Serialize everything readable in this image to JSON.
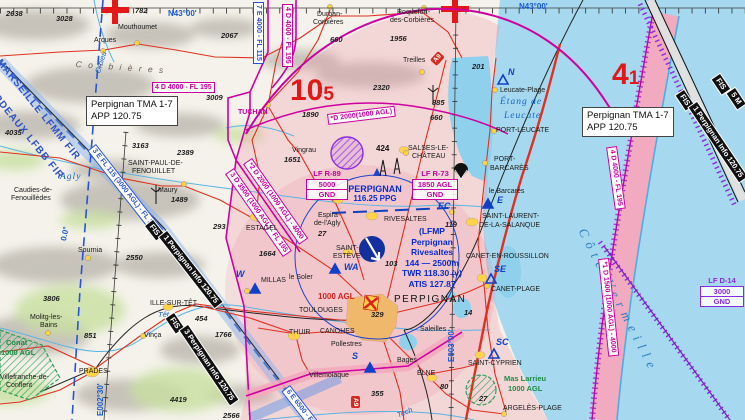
{
  "tma_note": {
    "line1": "Perpignan TMA 1-7",
    "line2": "APP 120.75"
  },
  "areas": {
    "r89": {
      "id": "LF R-89",
      "upper": "5000",
      "lower": "GND"
    },
    "r73": {
      "id": "LF R-73",
      "upper": "1850 AGL",
      "lower": "GND"
    },
    "d14": {
      "id": "LF D-14",
      "upper": "3000",
      "lower": "GND"
    }
  },
  "airport": {
    "icao": "(LFMP",
    "name1": "Perpignan",
    "name2": "Rivesaltes",
    "dims": "144 — 2500m",
    "twr": "TWR 118.30 (v)",
    "atis": "ATIS 127.87"
  },
  "vor": {
    "name": "PERPIGNAN",
    "freq": "116.25 PPG"
  },
  "max_elev": {
    "west": {
      "big": "10",
      "sub": "5"
    },
    "east": {
      "big": "4",
      "sub": "1"
    }
  },
  "badges": {
    "motorway": "A9"
  },
  "colors": {
    "airspace_d": "#c8009e",
    "airspace_e": "#2a52d0",
    "sea": "#a6d9ef",
    "tma_tint": "#f3b8c6",
    "road": "#e03020",
    "fis_band": "#101010",
    "water_text": "#1464c8",
    "red_figure": "#e01818"
  },
  "map": {
    "labels": [
      {
        "name": "lat-label-west",
        "text": "N43°00'",
        "x": 168,
        "y": 10,
        "cls": "blue-geo"
      },
      {
        "name": "lat-label-east",
        "text": "N43°00'",
        "x": 519,
        "y": 3,
        "cls": "blue-geo"
      },
      {
        "name": "lon-label-west",
        "text": "E002°30'",
        "x": 97,
        "y": 416,
        "cls": "blue-geo",
        "rot": -90
      },
      {
        "name": "lon-label-east",
        "text": "E003°00'",
        "x": 448,
        "y": 362,
        "cls": "blue-geo",
        "rot": -90
      },
      {
        "name": "agonic-label",
        "text": "0.0°",
        "x": 60,
        "y": 240,
        "cls": "blue-geo",
        "rot": -78
      },
      {
        "name": "fir-label-marseille",
        "text": "MARSEILLE LFMM FIR",
        "x": 2,
        "y": 58,
        "cls": "fir",
        "rot": 51
      },
      {
        "name": "fir-label-bordeaux",
        "text": "BORDEAUX LFBB FIR",
        "x": -12,
        "y": 80,
        "cls": "fir",
        "rot": 51
      },
      {
        "name": "river-orbieu",
        "text": "Orbieu",
        "x": 94,
        "y": 72,
        "cls": "water",
        "rot": -72
      },
      {
        "name": "range-corbieres",
        "text": "C o r b i è r e s",
        "x": 76,
        "y": 60,
        "cls": "range",
        "rot": 4
      },
      {
        "name": "river-agly",
        "text": "Agly",
        "x": 60,
        "y": 173,
        "cls": "water-lg"
      },
      {
        "name": "river-tet",
        "text": "Têt",
        "x": 158,
        "y": 311,
        "cls": "water"
      },
      {
        "name": "river-tech",
        "text": "Tech",
        "x": 396,
        "y": 412,
        "cls": "water",
        "rot": -22
      },
      {
        "name": "etang-leucate-1",
        "text": "Étang de",
        "x": 500,
        "y": 98,
        "cls": "water-lg"
      },
      {
        "name": "etang-leucate-2",
        "text": "Leucate",
        "x": 504,
        "y": 112,
        "cls": "water-lg"
      },
      {
        "name": "cote-vermeille",
        "text": "Côte Vermeille",
        "x": 588,
        "y": 226,
        "cls": "water-xl",
        "rot": 63
      },
      {
        "name": "asp-4d-west",
        "text": "4 D 4000 - FL 195",
        "x": 152,
        "y": 82,
        "cls": "asp asp-d"
      },
      {
        "name": "asp-7e-top",
        "text": "7 E 4000 - FL 115",
        "x": 264,
        "y": 2,
        "cls": "asp asp-e",
        "rot": 90
      },
      {
        "name": "asp-4d-top",
        "text": "4 D 4000 - FL 195",
        "x": 293,
        "y": 4,
        "cls": "asp asp-d",
        "rot": 90
      },
      {
        "name": "asp-4d-coast",
        "text": "4 D 4000 - FL 195",
        "x": 617,
        "y": 146,
        "cls": "asp asp-d",
        "rot": 82
      },
      {
        "name": "asp-1d-coast",
        "text": "*1 D 1500 (1000 AGL) - 4000",
        "x": 609,
        "y": 258,
        "cls": "asp asp-d",
        "rot": 84
      },
      {
        "name": "asp-d2000-arc",
        "text": "*D 2000(1000 AGL)",
        "x": 327,
        "y": 114,
        "cls": "asp asp-d",
        "rot": -7
      },
      {
        "name": "asp-2d",
        "text": "*2 D 2000 (1000 AGL) - 4000",
        "x": 252,
        "y": 158,
        "cls": "asp asp-d",
        "rot": 55
      },
      {
        "name": "asp-3d",
        "text": "3 D 3500 (1000 AGL) - FL 195",
        "x": 234,
        "y": 168,
        "cls": "asp asp-d",
        "rot": 55
      },
      {
        "name": "asp-3e",
        "text": "3 E FL 115 (3000 AGL) - FL 195",
        "x": 96,
        "y": 144,
        "cls": "asp asp-e",
        "rot": 52
      },
      {
        "name": "asp-6e",
        "text": "6 E 6500 - FL 115",
        "x": 290,
        "y": 385,
        "cls": "asp asp-e",
        "rot": 52
      },
      {
        "name": "fis-1-tag",
        "text": "FIS",
        "x": 153,
        "y": 220,
        "cls": "fis",
        "rot": 52
      },
      {
        "name": "fis-1-label",
        "text": "1 Perpignan Info 120.75",
        "x": 167,
        "y": 231,
        "cls": "fis",
        "rot": 52
      },
      {
        "name": "fis-3-tag",
        "text": "FIS",
        "x": 174,
        "y": 313,
        "cls": "fis",
        "rot": 56
      },
      {
        "name": "fis-3-label",
        "text": "3 Perpignan Info 120.75",
        "x": 188,
        "y": 325,
        "cls": "fis",
        "rot": 56
      },
      {
        "name": "fis-east-tag",
        "text": "FIS",
        "x": 684,
        "y": 90,
        "cls": "fis",
        "rot": 56
      },
      {
        "name": "fis-east-label",
        "text": "1 Perpignan Info 120.75",
        "x": 697,
        "y": 102,
        "cls": "fis",
        "rot": 56
      },
      {
        "name": "fis-east2-tag",
        "text": "FIS",
        "x": 720,
        "y": 74,
        "cls": "fis",
        "rot": 56
      },
      {
        "name": "fis-east2-label",
        "text": "5 M",
        "x": 735,
        "y": 88,
        "cls": "fis",
        "rot": 56
      },
      {
        "name": "vfr-point-n",
        "text": "N",
        "x": 508,
        "y": 68,
        "cls": "vfr"
      },
      {
        "name": "vfr-point-w",
        "text": "W",
        "x": 236,
        "y": 270,
        "cls": "vfr"
      },
      {
        "name": "vfr-point-wa",
        "text": "WA",
        "x": 344,
        "y": 263,
        "cls": "vfr"
      },
      {
        "name": "vfr-point-s",
        "text": "S",
        "x": 352,
        "y": 352,
        "cls": "vfr"
      },
      {
        "name": "vfr-point-e",
        "text": "E",
        "x": 497,
        "y": 196,
        "cls": "vfr"
      },
      {
        "name": "vfr-point-se",
        "text": "SE",
        "x": 494,
        "y": 265,
        "cls": "vfr"
      },
      {
        "name": "vfr-point-sc",
        "text": "SC",
        "x": 496,
        "y": 338,
        "cls": "vfr"
      },
      {
        "name": "vfr-point-ec",
        "text": "EC",
        "x": 438,
        "y": 202,
        "cls": "vfr"
      },
      {
        "name": "town-mouthoumet",
        "text": "Mouthoumet",
        "x": 118,
        "y": 24,
        "cls": "town"
      },
      {
        "name": "town-arques",
        "text": "Arques",
        "x": 94,
        "y": 37,
        "cls": "town"
      },
      {
        "name": "town-durban-1",
        "text": "Durban-",
        "x": 317,
        "y": 11,
        "cls": "town"
      },
      {
        "name": "town-durban-2",
        "text": "Corbières",
        "x": 313,
        "y": 19,
        "cls": "town"
      },
      {
        "name": "town-roquefort-1",
        "text": "Roquefort-",
        "x": 397,
        "y": 9,
        "cls": "town"
      },
      {
        "name": "town-roquefort-2",
        "text": "des-Corbières",
        "x": 390,
        "y": 17,
        "cls": "town"
      },
      {
        "name": "town-treilles",
        "text": "Treilles",
        "x": 403,
        "y": 57,
        "cls": "town"
      },
      {
        "name": "town-leucate-plage",
        "text": "Leucate-Plage",
        "x": 500,
        "y": 87,
        "cls": "town"
      },
      {
        "name": "town-port-leucate",
        "text": "PORT-LEUCATE",
        "x": 496,
        "y": 127,
        "cls": "town"
      },
      {
        "name": "town-tuchan",
        "text": "TUCHAN",
        "x": 238,
        "y": 109,
        "cls": "town magenta-town"
      },
      {
        "name": "town-st-paul-1",
        "text": "SAINT-PAUL-DE-",
        "x": 128,
        "y": 160,
        "cls": "town"
      },
      {
        "name": "town-st-paul-2",
        "text": "FENOUILLET",
        "x": 132,
        "y": 168,
        "cls": "town"
      },
      {
        "name": "town-caudies-1",
        "text": "Caudies-de-",
        "x": 14,
        "y": 187,
        "cls": "town"
      },
      {
        "name": "town-caudies-2",
        "text": "Fenouillèdes",
        "x": 11,
        "y": 195,
        "cls": "town"
      },
      {
        "name": "town-maury",
        "text": "Maury",
        "x": 158,
        "y": 187,
        "cls": "town"
      },
      {
        "name": "town-sournia",
        "text": "Sournia",
        "x": 78,
        "y": 247,
        "cls": "town"
      },
      {
        "name": "town-estagel",
        "text": "ESTAGEL",
        "x": 246,
        "y": 225,
        "cls": "town"
      },
      {
        "name": "town-vingrau",
        "text": "Vingrau",
        "x": 292,
        "y": 147,
        "cls": "town"
      },
      {
        "name": "town-salses-1",
        "text": "SALSES-LE-",
        "x": 408,
        "y": 145,
        "cls": "town"
      },
      {
        "name": "town-salses-2",
        "text": "CHÂTEAU",
        "x": 412,
        "y": 153,
        "cls": "town"
      },
      {
        "name": "town-espira-1",
        "text": "Espira-",
        "x": 318,
        "y": 212,
        "cls": "town"
      },
      {
        "name": "town-espira-2",
        "text": "de-l'Agly",
        "x": 314,
        "y": 220,
        "cls": "town"
      },
      {
        "name": "town-rivesaltes",
        "text": "RIVESALTES",
        "x": 384,
        "y": 216,
        "cls": "town"
      },
      {
        "name": "town-st-esteve-1",
        "text": "SAINT-",
        "x": 336,
        "y": 245,
        "cls": "town"
      },
      {
        "name": "town-st-esteve-2",
        "text": "ESTÈVE",
        "x": 333,
        "y": 253,
        "cls": "town"
      },
      {
        "name": "town-millas",
        "text": "MILLAS",
        "x": 261,
        "y": 277,
        "cls": "town"
      },
      {
        "name": "town-le-soler",
        "text": "le Soler",
        "x": 289,
        "y": 274,
        "cls": "town"
      },
      {
        "name": "town-ille-sur-tet",
        "text": "ILLE-SUR-TÊT",
        "x": 150,
        "y": 300,
        "cls": "town"
      },
      {
        "name": "town-vinca",
        "text": "Vinça",
        "x": 144,
        "y": 332,
        "cls": "town"
      },
      {
        "name": "town-molitg-1",
        "text": "Molitg-les-",
        "x": 30,
        "y": 314,
        "cls": "town"
      },
      {
        "name": "town-molitg-2",
        "text": "Bains",
        "x": 40,
        "y": 322,
        "cls": "town"
      },
      {
        "name": "town-prades",
        "text": "PRADES",
        "x": 79,
        "y": 368,
        "cls": "town"
      },
      {
        "name": "town-villefranche-1",
        "text": "Villefranche-de-",
        "x": 0,
        "y": 374,
        "cls": "town"
      },
      {
        "name": "town-villefranche-2",
        "text": "Conflent",
        "x": 6,
        "y": 382,
        "cls": "town"
      },
      {
        "name": "town-toulouges",
        "text": "TOULOUGES",
        "x": 299,
        "y": 307,
        "cls": "town"
      },
      {
        "name": "town-canohes",
        "text": "CANOHES",
        "x": 320,
        "y": 328,
        "cls": "town"
      },
      {
        "name": "town-thuir",
        "text": "THUIR",
        "x": 289,
        "y": 329,
        "cls": "town"
      },
      {
        "name": "town-pollestres",
        "text": "Pollestres",
        "x": 331,
        "y": 341,
        "cls": "town"
      },
      {
        "name": "town-villemolaque",
        "text": "Villemolaque",
        "x": 309,
        "y": 372,
        "cls": "town"
      },
      {
        "name": "town-bages",
        "text": "Bages",
        "x": 397,
        "y": 357,
        "cls": "town"
      },
      {
        "name": "town-elne",
        "text": "ELNE",
        "x": 417,
        "y": 370,
        "cls": "town"
      },
      {
        "name": "town-saleilles",
        "text": "Saleilles",
        "x": 420,
        "y": 326,
        "cls": "town"
      },
      {
        "name": "town-st-cyprien",
        "text": "SAINT-CYPRIEN",
        "x": 468,
        "y": 360,
        "cls": "town"
      },
      {
        "name": "town-argeles-plage",
        "text": "ARGELÈS-PLAGE",
        "x": 503,
        "y": 405,
        "cls": "town"
      },
      {
        "name": "town-canet-en-roussillon",
        "text": "CANET-EN-ROUSSILLON",
        "x": 466,
        "y": 253,
        "cls": "town"
      },
      {
        "name": "town-canet-plage",
        "text": "CANET-PLAGE",
        "x": 491,
        "y": 286,
        "cls": "town"
      },
      {
        "name": "town-st-laurent-1",
        "text": "SAINT-LAURENT-",
        "x": 482,
        "y": 213,
        "cls": "town"
      },
      {
        "name": "town-st-laurent-2",
        "text": "DE-LA-SALANQUE",
        "x": 479,
        "y": 222,
        "cls": "town"
      },
      {
        "name": "town-port-barcares-1",
        "text": "PORT-",
        "x": 494,
        "y": 156,
        "cls": "town"
      },
      {
        "name": "town-port-barcares-2",
        "text": "BARCARÈS",
        "x": 490,
        "y": 165,
        "cls": "town"
      },
      {
        "name": "town-le-barcares",
        "text": "le Barcarès",
        "x": 489,
        "y": 188,
        "cls": "town"
      },
      {
        "name": "city-perpignan",
        "text": "PERPIGNAN",
        "x": 394,
        "y": 295,
        "cls": "town-lg"
      },
      {
        "name": "reserve-conat-1",
        "text": "Conat",
        "x": 6,
        "y": 339,
        "cls": "green"
      },
      {
        "name": "reserve-conat-2",
        "text": "1000 AGL",
        "x": 1,
        "y": 349,
        "cls": "green"
      },
      {
        "name": "reserve-mas-larrieu-1",
        "text": "Mas Larrieu",
        "x": 504,
        "y": 375,
        "cls": "green"
      },
      {
        "name": "reserve-mas-larrieu-2",
        "text": "1000 AGL",
        "x": 508,
        "y": 385,
        "cls": "green"
      },
      {
        "name": "city-max-alt",
        "text": "1000 AGL",
        "x": 318,
        "y": 293,
        "cls": "red-alt"
      },
      {
        "name": "spot-2638",
        "text": "2638",
        "x": 6,
        "y": 10,
        "cls": "spot"
      },
      {
        "name": "spot-3028",
        "text": "3028",
        "x": 56,
        "y": 15,
        "cls": "spot"
      },
      {
        "name": "spot-782",
        "text": "782",
        "x": 135,
        "y": 7,
        "cls": "spot"
      },
      {
        "name": "spot-2067",
        "text": "2067",
        "x": 221,
        "y": 32,
        "cls": "spot"
      },
      {
        "name": "spot-3055",
        "text": "3055",
        "x": 93,
        "y": 97,
        "cls": "spot"
      },
      {
        "name": "spot-2979",
        "text": "2979",
        "x": 119,
        "y": 97,
        "cls": "spot"
      },
      {
        "name": "spot-3009",
        "text": "3009",
        "x": 206,
        "y": 94,
        "cls": "spot"
      },
      {
        "name": "spot-4035",
        "text": "4035",
        "x": 5,
        "y": 129,
        "cls": "spot"
      },
      {
        "name": "spot-3163",
        "text": "3163",
        "x": 132,
        "y": 142,
        "cls": "spot"
      },
      {
        "name": "spot-2389",
        "text": "2389",
        "x": 177,
        "y": 149,
        "cls": "spot"
      },
      {
        "name": "spot-2550",
        "text": "2550",
        "x": 126,
        "y": 254,
        "cls": "spot"
      },
      {
        "name": "spot-3806",
        "text": "3806",
        "x": 43,
        "y": 295,
        "cls": "spot"
      },
      {
        "name": "spot-851",
        "text": "851",
        "x": 84,
        "y": 332,
        "cls": "spot"
      },
      {
        "name": "spot-4419",
        "text": "4419",
        "x": 170,
        "y": 396,
        "cls": "spot"
      },
      {
        "name": "spot-2566",
        "text": "2566",
        "x": 223,
        "y": 412,
        "cls": "spot"
      },
      {
        "name": "spot-1890",
        "text": "1890",
        "x": 302,
        "y": 111,
        "cls": "spot"
      },
      {
        "name": "spot-2320",
        "text": "2320",
        "x": 373,
        "y": 84,
        "cls": "spot"
      },
      {
        "name": "spot-660-durban",
        "text": "660",
        "x": 330,
        "y": 36,
        "cls": "spot"
      },
      {
        "name": "spot-1956",
        "text": "1956",
        "x": 390,
        "y": 35,
        "cls": "spot"
      },
      {
        "name": "spot-885",
        "text": "885",
        "x": 432,
        "y": 99,
        "cls": "spot"
      },
      {
        "name": "spot-660-treilles",
        "text": "660",
        "x": 430,
        "y": 114,
        "cls": "spot"
      },
      {
        "name": "spot-201",
        "text": "201",
        "x": 472,
        "y": 63,
        "cls": "spot"
      },
      {
        "name": "spot-1651",
        "text": "1651",
        "x": 284,
        "y": 156,
        "cls": "spot"
      },
      {
        "name": "obstacle-424",
        "text": "424",
        "x": 376,
        "y": 145,
        "cls": "spot-bold"
      },
      {
        "name": "spot-1489",
        "text": "1489",
        "x": 171,
        "y": 196,
        "cls": "spot"
      },
      {
        "name": "spot-293",
        "text": "293",
        "x": 213,
        "y": 223,
        "cls": "spot"
      },
      {
        "name": "spot-1664",
        "text": "1664",
        "x": 259,
        "y": 250,
        "cls": "spot"
      },
      {
        "name": "spot-1766",
        "text": "1766",
        "x": 215,
        "y": 331,
        "cls": "spot"
      },
      {
        "name": "spot-454",
        "text": "454",
        "x": 195,
        "y": 315,
        "cls": "spot"
      },
      {
        "name": "spot-119",
        "text": "119",
        "x": 445,
        "y": 221,
        "cls": "spot"
      },
      {
        "name": "spot-103",
        "text": "103",
        "x": 385,
        "y": 260,
        "cls": "spot"
      },
      {
        "name": "spot-329",
        "text": "329",
        "x": 371,
        "y": 311,
        "cls": "spot"
      },
      {
        "name": "spot-355",
        "text": "355",
        "x": 371,
        "y": 390,
        "cls": "spot"
      },
      {
        "name": "spot-80",
        "text": "80",
        "x": 440,
        "y": 383,
        "cls": "spot"
      },
      {
        "name": "spot-27-espira",
        "text": "27",
        "x": 318,
        "y": 230,
        "cls": "spot"
      },
      {
        "name": "spot-27-argeles",
        "text": "27",
        "x": 479,
        "y": 395,
        "cls": "spot"
      },
      {
        "name": "spot-14",
        "text": "14",
        "x": 464,
        "y": 309,
        "cls": "spot"
      }
    ]
  }
}
